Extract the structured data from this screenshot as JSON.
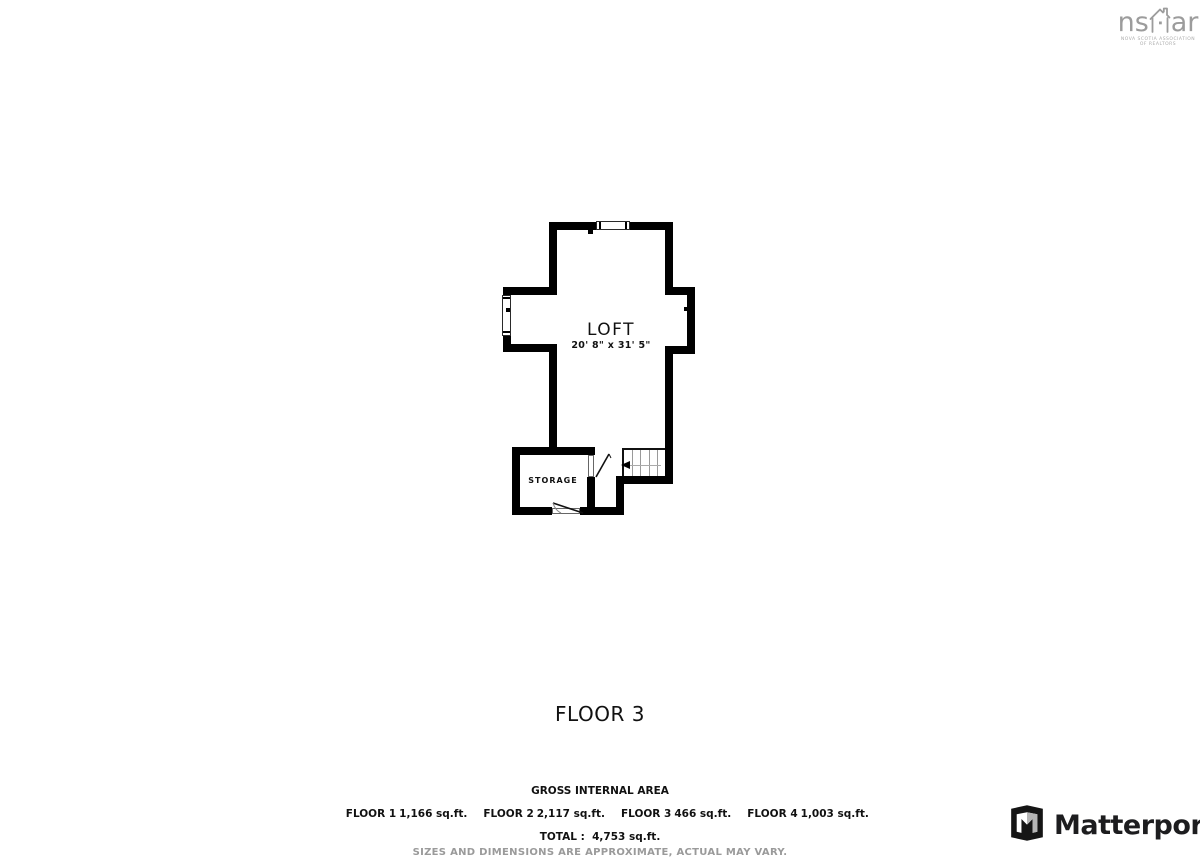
{
  "title": "FLOOR 3",
  "floor_plan": {
    "wall_color": "#000000",
    "rooms": [
      {
        "name": "LOFT",
        "dimensions": "20' 8\" x 31' 5\""
      },
      {
        "name": "STORAGE",
        "dimensions": ""
      }
    ]
  },
  "footer": {
    "heading": "GROSS INTERNAL AREA",
    "floors": [
      {
        "label": "FLOOR 1",
        "area": "1,166 sq.ft."
      },
      {
        "label": "FLOOR 2",
        "area": "2,117 sq.ft."
      },
      {
        "label": "FLOOR 3",
        "area": "466 sq.ft."
      },
      {
        "label": "FLOOR 4",
        "area": "1,003 sq.ft."
      }
    ],
    "total_line": "TOTAL :  4,753 sq.ft.",
    "disclaimer": "SIZES AND DIMENSIONS ARE APPROXIMATE, ACTUAL MAY VARY."
  },
  "branding": {
    "nsar": {
      "text_left": "ns",
      "text_right": "ar",
      "caption_line1": "NOVA SCOTIA ASSOCIATION",
      "caption_line2": "OF REALTORS",
      "color": "#9c9c9c"
    },
    "matterport": {
      "label": "Matterport",
      "color": "#1d1d1f"
    }
  }
}
